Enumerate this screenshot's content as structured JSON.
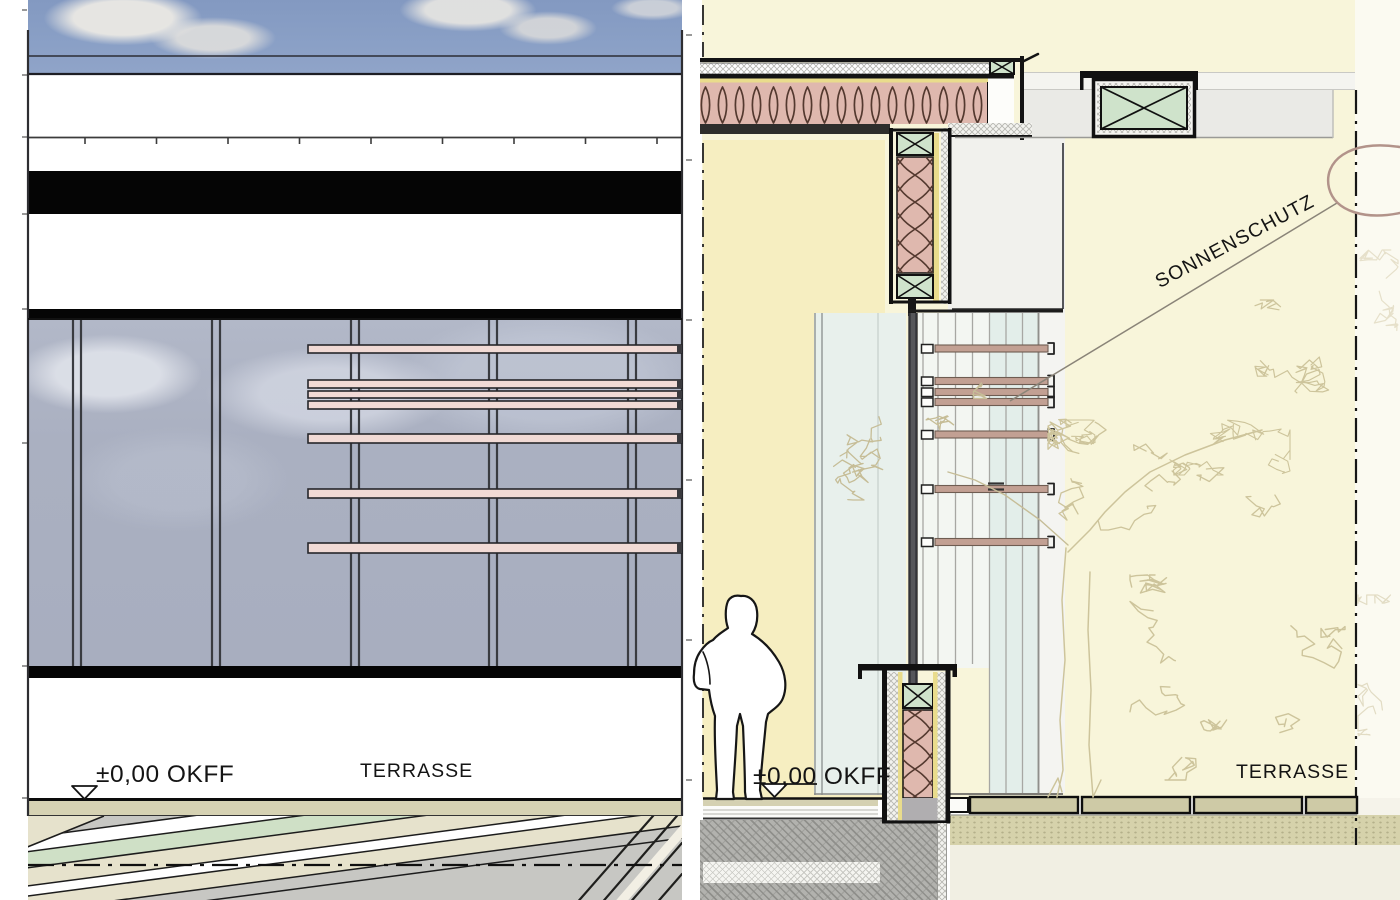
{
  "labels": {
    "elevation_level": "±0,00  OKFF",
    "elevation_terrace": "TERRASSE",
    "section_level": "±0,00  OKFF",
    "section_terrace": "TERRASSE",
    "section_sunshade": "SONNENSCHUTZ"
  },
  "palette": {
    "sky_blue": "#8aa0c6",
    "glass_reflection": "#aab0c1",
    "elevation_louver_pink": "#f1dad5",
    "section_louver_tan": "#c2a093",
    "band_black": "#050505",
    "slab_khaki": "#d6d2b3",
    "hatch_green": "#cfe0c6",
    "hatch_beige": "#e6e2cc",
    "outdoor_yellow": "#f8f5da",
    "interior_yellow": "#f6eec1",
    "insulation_pink": "#dfb8ae",
    "insulation_line": "#54392f",
    "wood_green": "#cfe3cb",
    "liner_yellow": "#e9dc8c",
    "cavity_glass": "#e8f0ec",
    "concrete_gray": "#b2b2ae",
    "gravel_khaki": "#d6d2ab",
    "paving_khaki": "#cecaa6",
    "tree_sketch": "#cdc49b",
    "leader_arc_brown": "#b2938a"
  },
  "geometry": {
    "elevation": {
      "edge_x": [
        28,
        682
      ],
      "mullions_x": [
        77,
        216,
        355,
        493,
        632
      ],
      "louver_span": [
        308,
        682
      ],
      "louvers": [
        {
          "y": 345,
          "h": 8
        },
        {
          "y": 380,
          "h": 8
        },
        {
          "y": 391,
          "h": 7
        },
        {
          "y": 401,
          "h": 8
        },
        {
          "y": 434,
          "h": 9
        },
        {
          "y": 489,
          "h": 9
        },
        {
          "y": 543,
          "h": 10
        }
      ],
      "coping_ticks": {
        "y": 138,
        "x0": 85,
        "step": 71.5,
        "count": 9
      }
    },
    "section": {
      "louvers_y": [
        345,
        377.5,
        388.5,
        398.5,
        431,
        485.5,
        538.5
      ],
      "louver_span": [
        935,
        1048
      ],
      "rails_front_x": [
        923,
        938,
        955.5,
        972.5
      ],
      "rails_back_x": [
        989.5,
        1006,
        1022.5,
        1038.5
      ],
      "paving_x": [
        970,
        1082,
        1194,
        1306
      ],
      "paving_w": 108,
      "paving_cut_x": 1357
    }
  }
}
